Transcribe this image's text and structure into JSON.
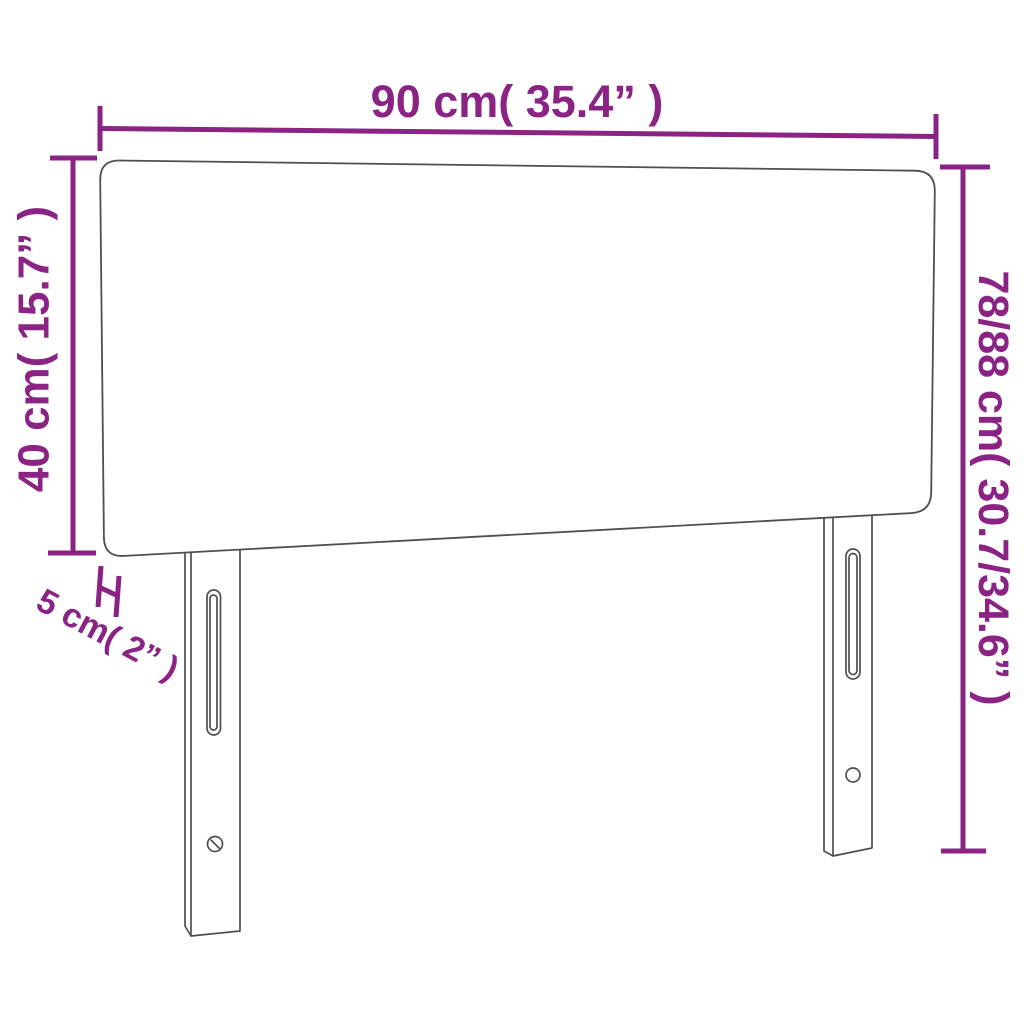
{
  "diagram": {
    "kind": "product-dimension-diagram",
    "subject": "headboard"
  },
  "colors": {
    "accent": "#8a2383",
    "outline": "#4f4f4f",
    "background": "#ffffff"
  },
  "dimensions": {
    "width": {
      "cm": "90",
      "inches": "35.4",
      "label": "90 cm( 35.4” )"
    },
    "panel_height": {
      "cm": "40",
      "inches": "15.7",
      "label": "40 cm( 15.7” )"
    },
    "total_height": {
      "cm": "78/88",
      "inches": "30.7/34.6",
      "label": "78/88 cm( 30.7/34.6” )"
    },
    "thickness": {
      "cm": "5",
      "inches": "2",
      "label": "5 cm( 2” )"
    }
  }
}
